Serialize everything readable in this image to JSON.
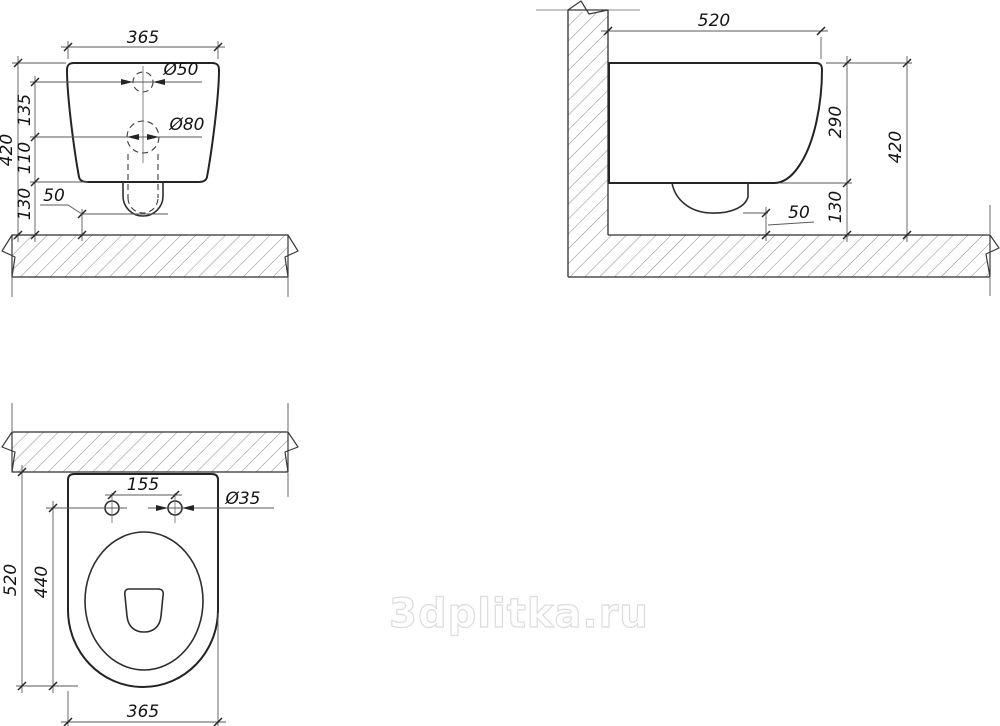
{
  "meta": {
    "drawing_type": "wall-hung toilet installation dimensions, three orthographic views",
    "line_color": "#242424",
    "hatch_color": "#7d7d7d",
    "watermark_color": "#dcdcdc",
    "background": "#ffffff"
  },
  "watermark": {
    "text": "3dplitka.ru"
  },
  "views": {
    "front": {
      "dims": {
        "width": "365",
        "top_hole_dia": "Ø50",
        "mid_hole_dia": "Ø80",
        "hole_to_hole": "135",
        "hole_to_bottom": "110",
        "bottom_to_floor": "130",
        "overall_height": "420",
        "outlet_clearance": "50"
      }
    },
    "side": {
      "dims": {
        "depth": "520",
        "body_height": "290",
        "overall_height": "420",
        "floor_gap": "130",
        "outlet_clearance": "50"
      }
    },
    "plan": {
      "dims": {
        "bolt_spacing": "155",
        "bolt_hole_dia": "Ø35",
        "wall_to_front": "520",
        "holes_to_front": "440",
        "width": "365"
      }
    }
  }
}
